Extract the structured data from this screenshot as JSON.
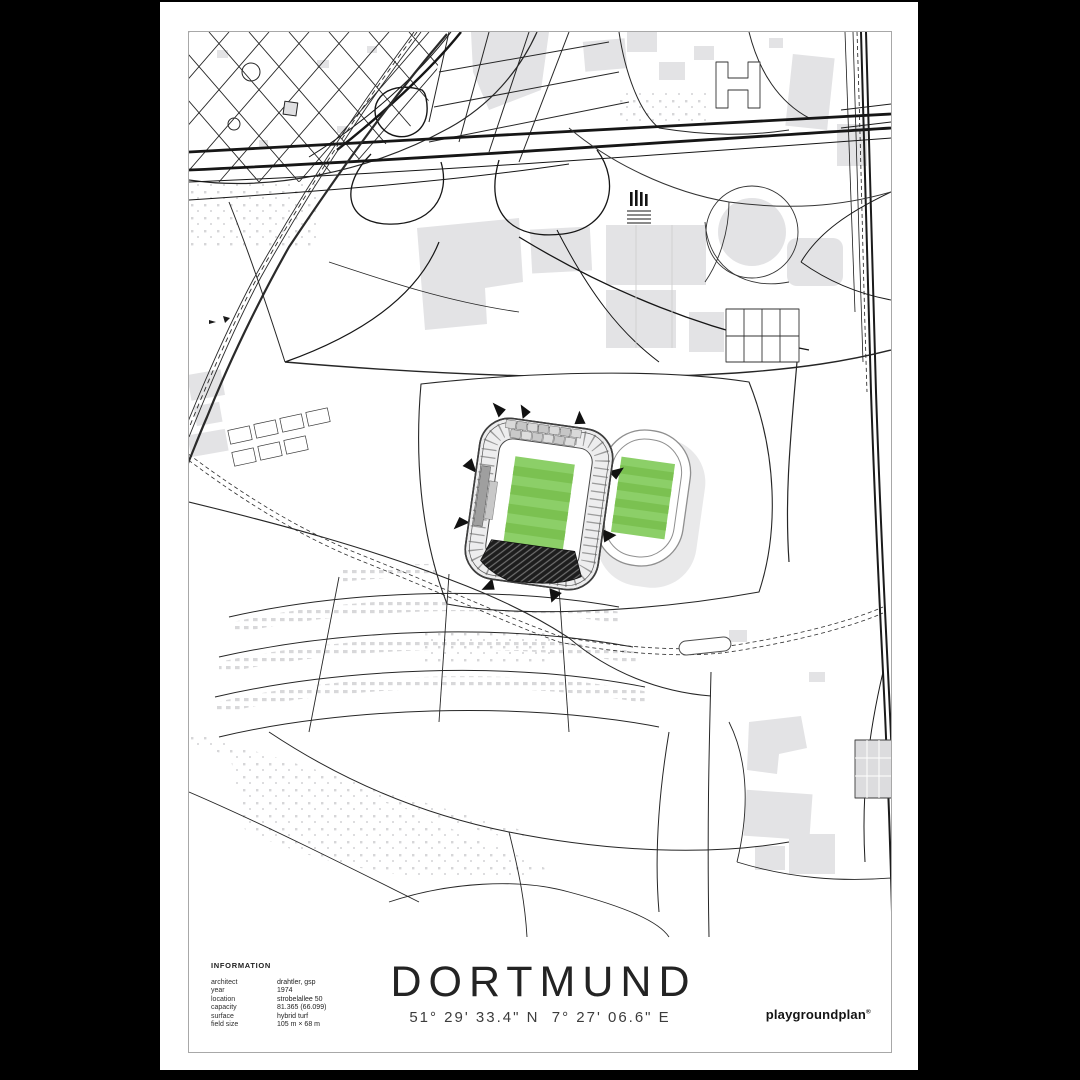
{
  "poster": {
    "title": "DORTMUND",
    "coordinates": "51° 29' 33.4\" N  7° 27' 06.6\" E",
    "brand": {
      "name": "playgroundplan",
      "registered_mark": "®"
    },
    "info": {
      "heading": "INFORMATION",
      "rows": [
        {
          "label": "architect",
          "value": "drahtler, gsp"
        },
        {
          "label": "year",
          "value": "1974"
        },
        {
          "label": "location",
          "value": "strobelallee 50"
        },
        {
          "label": "capacity",
          "value": "81.365 (66.099)"
        },
        {
          "label": "surface",
          "value": "hybrid turf"
        },
        {
          "label": "field size",
          "value": "105 m × 68 m"
        }
      ]
    },
    "colors": {
      "backdrop": "#000000",
      "paper": "#ffffff",
      "map_line": "#1f1f1f",
      "building_gray": "#e3e3e5",
      "pitch_green_base": "#8ccf68",
      "pitch_green_stripe": "#7bc151"
    }
  }
}
